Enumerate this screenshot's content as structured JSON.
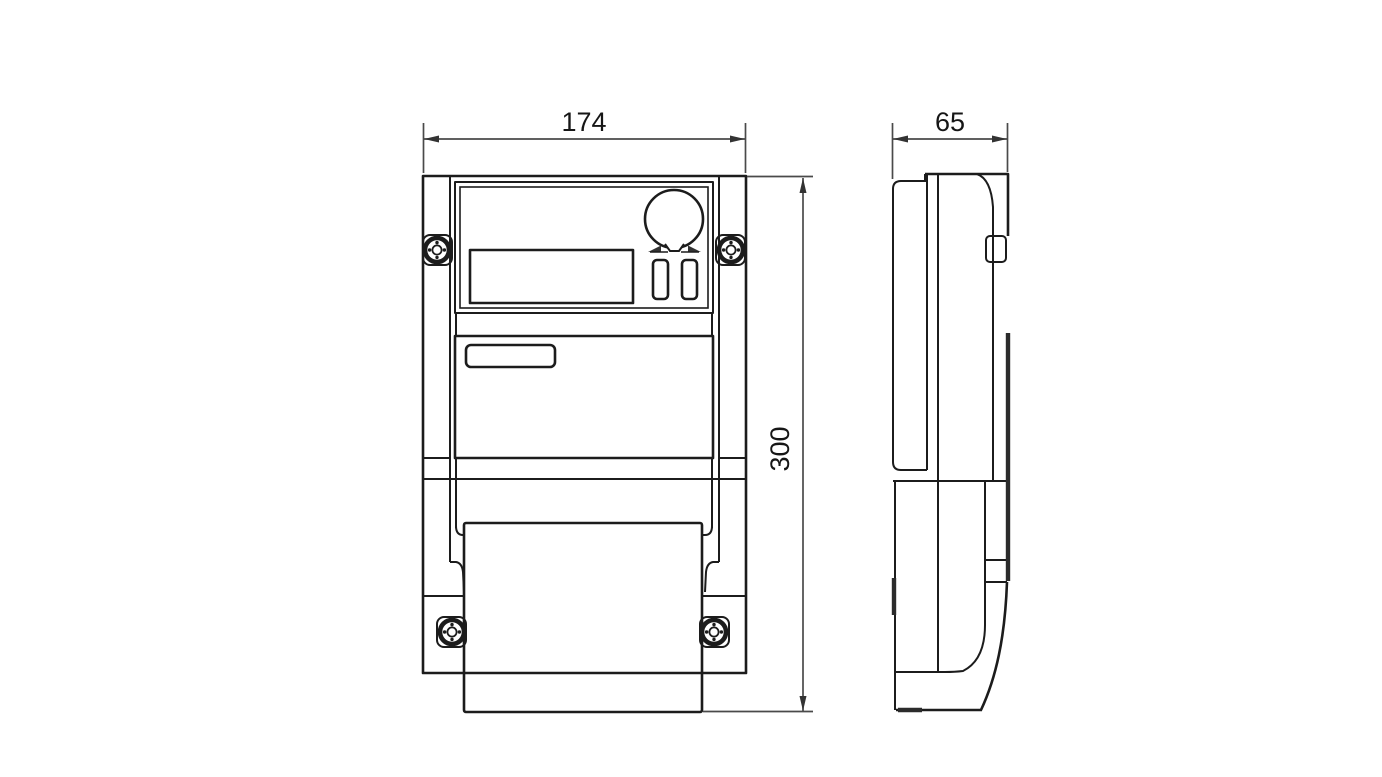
{
  "drawing": {
    "kind": "technical-dimension-drawing",
    "subject": "electricity-meter-outline",
    "views": {
      "front": "front-view",
      "side": "side-view"
    },
    "dimensions": {
      "width": "174",
      "depth": "65",
      "height": "300"
    },
    "colors": {
      "background": "#ffffff",
      "outline": "#1c1c1c",
      "heavy_edge": "#2b2b2b",
      "dimension_line": "#4a4a4a",
      "dimension_text": "#161616"
    }
  }
}
